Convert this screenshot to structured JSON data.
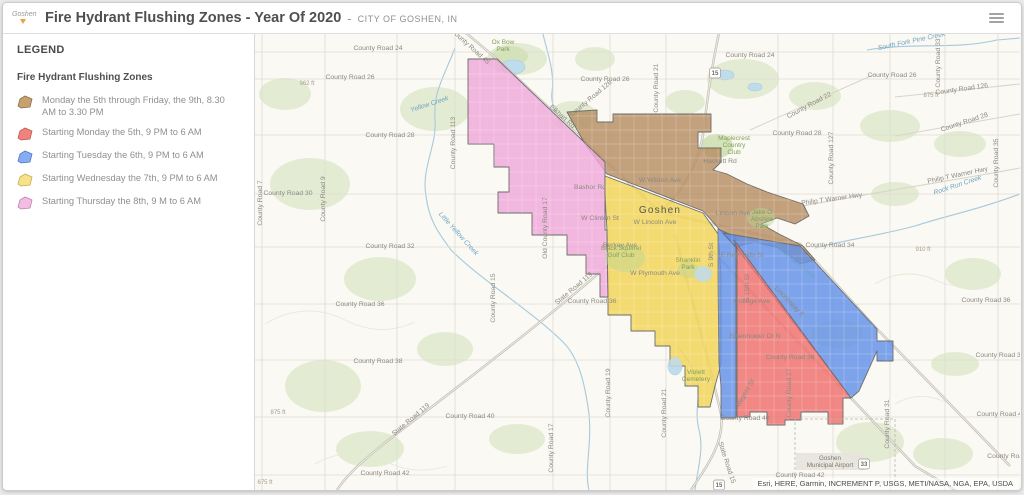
{
  "header": {
    "logo": "Goshen",
    "title": "Fire Hydrant Flushing Zones - Year Of 2020",
    "dash": "-",
    "org": "CITY OF GOSHEN, IN"
  },
  "legend": {
    "panel_title": "LEGEND",
    "layer_title": "Fire Hydrant Flushing Zones",
    "items": [
      {
        "label": "Monday the 5th through Friday, the 9th, 8.30 AM to 3.30 PM",
        "fill": "#C7A06F",
        "stroke": "#8F6F45"
      },
      {
        "label": "Starting Monday the 5th, 9 PM to 6 AM",
        "fill": "#F0837B",
        "stroke": "#C2574F"
      },
      {
        "label": "Starting Tuesday the 6th, 9 PM to 6 AM",
        "fill": "#86ACF1",
        "stroke": "#5377BF"
      },
      {
        "label": "Starting Wednesday the 7th, 9 PM to 6 AM",
        "fill": "#F6E388",
        "stroke": "#C3AC4E"
      },
      {
        "label": "Starting Thursday the 8th, 9 M to 6 AM",
        "fill": "#F4BCE3",
        "stroke": "#C081AC"
      }
    ]
  },
  "map": {
    "attribution": "Esri, HERE, Garmin, INCREMENT P, USGS, METI/NASA, NGA, EPA, USDA",
    "colors": {
      "bg": "#FAF9F3",
      "green": "#E3ECD3",
      "green_dark": "#D3E2B8",
      "park_overlay": "#BCD49A",
      "water": "#A6C9DE",
      "pond": "#BFDCEC",
      "grid": "#DEDCD3",
      "road": "#C6C3B9",
      "road_casing": "#BFBCB2",
      "road_core": "#EFEDE6",
      "boundary": "#6B6B6B",
      "contour": "#ECE7D6",
      "airport_box": "#E6E3DC",
      "dash_line": "#B8B5AA",
      "shield_border": "#9A968C"
    },
    "zones": [
      {
        "id": "monday-friday-day",
        "color": "#B78E63",
        "points": "312,78 342,76 342,88 358,88 358,80 456,80 456,98 443,98 443,114 466,114 466,128 458,136 472,140 492,150 512,158 530,164 548,170 554,182 540,190 522,184 506,190 524,200 548,212 560,226 545,230 524,214 500,208 480,213 465,196 448,177 352,140 330,110"
      },
      {
        "id": "thursday-night",
        "color": "#F0A8DB",
        "points": "213,25 242,25 350,128 350,196 352,196 353,263 345,263 345,240 331,240 331,221 312,221 312,201 277,201 277,179 243,179 243,158 254,158 254,133 239,133 239,110 213,110"
      },
      {
        "id": "wednesday-night",
        "color": "#F1D455",
        "points": "350,142 448,179 463,200 466,240 466,330 460,352 455,373 443,373 443,352 430,352 430,332 415,332 415,312 400,312 400,297 376,297 376,281 353,281 353,263 352,196 350,160"
      },
      {
        "id": "tuesday-night-strip",
        "color": "#6290E8",
        "points": "463,195 481,203 481,384 466,384 466,352 464,330 463,250"
      },
      {
        "id": "tuesday-night-wedge",
        "color": "#6290E8",
        "points": "468,199 545,212 622,295 622,307 638,307 638,327 622,327 622,317 604,357 596,364 480,212"
      },
      {
        "id": "monday-night",
        "color": "#EF6F6D",
        "points": "479,206 596,364 588,364 588,390 573,390 573,378 546,378 546,386 530,386 530,391 512,391 512,378 495,378 495,383 482,383 482,214"
      }
    ],
    "grid": {
      "v": [
        7,
        70,
        142,
        200,
        298,
        355,
        411,
        523,
        578,
        635,
        690,
        743
      ],
      "h": [
        18,
        45,
        101,
        160,
        213,
        270,
        326,
        383,
        441
      ]
    },
    "major_roads": [
      "M205,-6 L242,25 L405,178",
      "M405,178 L545,210 L622,295 L755,432",
      "M455,214 L596,364 L660,432 L700,456",
      "M465,-6 C455,40 452,70 448,100 C444,130 425,160 408,176",
      "M420,200 C435,260 455,330 466,380 C470,408 452,432 436,456",
      "M352,232 C300,278 220,340 157,388 C120,416 95,436 82,456"
    ],
    "roads": [
      "M495,96 L620,40",
      "M640,63 L765,50",
      "M640,102 L765,80",
      "M548,172 C610,160 690,148 765,134"
    ],
    "contours": [
      "M10,290 q40,-24 80,-4 q36,18 70,2",
      "M620,250 q30,-18 60,-4 q26,12 52,0",
      "M60,430 q36,-20 72,-2 q30,14 60,4",
      "M640,370 q24,-14 50,-2"
    ],
    "green_areas": [
      [
        262,
        25,
        30,
        16
      ],
      [
        180,
        75,
        35,
        22
      ],
      [
        55,
        150,
        40,
        26
      ],
      [
        125,
        245,
        36,
        22
      ],
      [
        68,
        352,
        38,
        26
      ],
      [
        190,
        315,
        28,
        17
      ],
      [
        318,
        82,
        24,
        15
      ],
      [
        488,
        45,
        36,
        20
      ],
      [
        560,
        62,
        26,
        14
      ],
      [
        635,
        92,
        30,
        16
      ],
      [
        705,
        110,
        26,
        13
      ],
      [
        640,
        160,
        24,
        12
      ],
      [
        718,
        240,
        28,
        16
      ],
      [
        615,
        408,
        34,
        20
      ],
      [
        688,
        420,
        30,
        16
      ],
      [
        115,
        415,
        34,
        18
      ],
      [
        262,
        405,
        28,
        15
      ],
      [
        430,
        68,
        20,
        12
      ],
      [
        582,
        300,
        26,
        14
      ],
      [
        700,
        330,
        24,
        12
      ],
      [
        30,
        60,
        26,
        16
      ],
      [
        340,
        25,
        20,
        12
      ]
    ],
    "green_dark_areas": [
      [
        462,
        112,
        16,
        12
      ],
      [
        255,
        22,
        18,
        10
      ]
    ],
    "park_overlays": [
      [
        506,
        184,
        14,
        10
      ],
      [
        433,
        236,
        11,
        8
      ],
      [
        370,
        224,
        20,
        14
      ]
    ],
    "creeks": [
      "M200,14 C188,45 178,58 180,86 C182,112 166,134 171,162 C174,188 186,202 196,216 C226,246 278,278 308,308 C324,324 330,350 334,380 C337,412 329,436 334,456",
      "M288,0 C292,18 300,38 297,58 C295,74 306,88 310,98",
      "M612,16 C660,8 700,16 742,6 L765,4",
      "M765,160 C722,176 690,182 660,192 C622,202 590,206 560,214",
      "M440,456 C443,432 449,416 444,396 C439,376 446,362 442,346 C438,332 430,322 424,314"
    ],
    "ponds": [
      [
        258,
        33,
        12,
        7
      ],
      [
        470,
        41,
        9,
        5
      ],
      [
        500,
        53,
        7,
        4
      ],
      [
        448,
        240,
        9,
        8
      ],
      [
        420,
        332,
        7,
        9
      ]
    ],
    "pond_overlays": [
      [
        448,
        240,
        9,
        8
      ],
      [
        420,
        332,
        7,
        9
      ]
    ],
    "airport": {
      "box": "540,385 640,385 640,448 540,448",
      "bg": [
        541,
        419,
        68,
        17
      ]
    },
    "labels": [
      {
        "t": "County Road 24",
        "x": 123,
        "y": 16,
        "c": "rd"
      },
      {
        "t": "County Road 24",
        "x": 495,
        "y": 23,
        "c": "rd"
      },
      {
        "t": "County Road 26",
        "x": 95,
        "y": 45,
        "c": "rd"
      },
      {
        "t": "County Road 26",
        "x": 350,
        "y": 47,
        "c": "rd"
      },
      {
        "t": "County Road 26",
        "x": 637,
        "y": 43,
        "c": "rd"
      },
      {
        "t": "County Road 126",
        "x": 707,
        "y": 57,
        "r": -8,
        "c": "rd"
      },
      {
        "t": "County Road 126",
        "x": 337,
        "y": 66,
        "r": -40,
        "c": "rd"
      },
      {
        "t": "County Road 28",
        "x": 135,
        "y": 103,
        "c": "rd"
      },
      {
        "t": "County Road 28",
        "x": 542,
        "y": 101,
        "c": "rd"
      },
      {
        "t": "County Road 28",
        "x": 710,
        "y": 90,
        "r": -18,
        "c": "rd"
      },
      {
        "t": "County Road 30",
        "x": 33,
        "y": 161,
        "c": "rd"
      },
      {
        "t": "County Road 32",
        "x": 135,
        "y": 214,
        "c": "rd"
      },
      {
        "t": "County Road 34",
        "x": 575,
        "y": 213,
        "c": "rd"
      },
      {
        "t": "County Road 36",
        "x": 105,
        "y": 272,
        "c": "rd"
      },
      {
        "t": "County Road 36",
        "x": 337,
        "y": 269,
        "c": "rd"
      },
      {
        "t": "County Road 36",
        "x": 731,
        "y": 268,
        "c": "rd"
      },
      {
        "t": "County Road 38",
        "x": 123,
        "y": 329,
        "c": "rd"
      },
      {
        "t": "County Road 38",
        "x": 535,
        "y": 325,
        "c": "rd"
      },
      {
        "t": "County Road 38",
        "x": 745,
        "y": 323,
        "c": "rd"
      },
      {
        "t": "County Road 40",
        "x": 215,
        "y": 384,
        "c": "rd"
      },
      {
        "t": "County Road 40",
        "x": 490,
        "y": 386,
        "c": "rd"
      },
      {
        "t": "County Road 40",
        "x": 746,
        "y": 382,
        "c": "rd"
      },
      {
        "t": "County Road 42",
        "x": 130,
        "y": 441,
        "c": "rd"
      },
      {
        "t": "County Road 42",
        "x": 545,
        "y": 443,
        "c": "rd"
      },
      {
        "t": "County Road",
        "x": 752,
        "y": 424,
        "c": "rd"
      },
      {
        "t": "County Road 7",
        "x": 7,
        "y": 169,
        "r": -90,
        "c": "rd"
      },
      {
        "t": "County Road 9",
        "x": 70,
        "y": 165,
        "r": -90,
        "c": "rd"
      },
      {
        "t": "County Road 113",
        "x": 200,
        "y": 109,
        "r": -90,
        "c": "rd"
      },
      {
        "t": "County Road 15",
        "x": 240,
        "y": 264,
        "r": -90,
        "c": "rd"
      },
      {
        "t": "Old County Road 17",
        "x": 292,
        "y": 194,
        "r": -90,
        "c": "rd"
      },
      {
        "t": "County Road 17",
        "x": 298,
        "y": 414,
        "r": -90,
        "c": "rd"
      },
      {
        "t": "County Road 19",
        "x": 355,
        "y": 359,
        "r": -90,
        "c": "rd"
      },
      {
        "t": "County Road 21",
        "x": 403,
        "y": 54,
        "r": -90,
        "c": "rd"
      },
      {
        "t": "County Road 21",
        "x": 411,
        "y": 379,
        "r": -90,
        "c": "rd"
      },
      {
        "t": "County Road 31",
        "x": 634,
        "y": 390,
        "r": -90,
        "c": "rd"
      },
      {
        "t": "County Road 33",
        "x": 685,
        "y": 29,
        "r": -90,
        "c": "rd"
      },
      {
        "t": "County Road 35",
        "x": 743,
        "y": 129,
        "r": -90,
        "c": "rd"
      },
      {
        "t": "County Road 127",
        "x": 578,
        "y": 124,
        "r": -90,
        "c": "rd"
      },
      {
        "t": "County Road 22",
        "x": 555,
        "y": 73,
        "r": -28,
        "c": "rd"
      },
      {
        "t": "County Road 45",
        "x": 214,
        "y": 14,
        "r": 42,
        "c": "rd"
      },
      {
        "t": "Elkhart Rd",
        "x": 306,
        "y": 84,
        "r": 42,
        "c": "rd"
      },
      {
        "t": "State Road 119",
        "x": 320,
        "y": 256,
        "r": -40,
        "c": "rd"
      },
      {
        "t": "State Road 119",
        "x": 157,
        "y": 387,
        "r": -40,
        "c": "rd"
      },
      {
        "t": "State Road 15",
        "x": 470,
        "y": 429,
        "r": 72,
        "c": "rd"
      },
      {
        "t": "Philip T Warner Hwy",
        "x": 577,
        "y": 167,
        "r": -8,
        "c": "rd"
      },
      {
        "t": "Philip T Warner Hwy",
        "x": 703,
        "y": 143,
        "r": -12,
        "c": "rd"
      },
      {
        "t": "Lincolnway E",
        "x": 533,
        "y": 269,
        "r": 46,
        "c": "rd"
      },
      {
        "t": "Bashor Rd",
        "x": 335,
        "y": 155,
        "c": "rd"
      },
      {
        "t": "W Clinton St",
        "x": 345,
        "y": 186,
        "c": "rd"
      },
      {
        "t": "Hackett Rd",
        "x": 465,
        "y": 129,
        "c": "rd"
      },
      {
        "t": "W Wilden Ave",
        "x": 405,
        "y": 148,
        "c": "rd"
      },
      {
        "t": "W Lincoln Ave",
        "x": 400,
        "y": 190,
        "c": "rd"
      },
      {
        "t": "Lincoln Ave",
        "x": 478,
        "y": 181,
        "c": "rd"
      },
      {
        "t": "Berkey Ave",
        "x": 365,
        "y": 213,
        "c": "rd"
      },
      {
        "t": "W Plymouth Ave",
        "x": 400,
        "y": 241,
        "c": "rd"
      },
      {
        "t": "College Ave",
        "x": 497,
        "y": 269,
        "c": "rd"
      },
      {
        "t": "E Reynolds St",
        "x": 487,
        "y": 223,
        "c": "rd"
      },
      {
        "t": "Eisenhower Dr N",
        "x": 500,
        "y": 304,
        "c": "rd"
      },
      {
        "t": "Regent St",
        "x": 492,
        "y": 360,
        "r": -60,
        "c": "rd"
      },
      {
        "t": "County Road 27",
        "x": 536,
        "y": 359,
        "r": -90,
        "c": "rd"
      },
      {
        "t": "S 15th St",
        "x": 494,
        "y": 254,
        "r": -90,
        "c": "rd"
      },
      {
        "t": "S 9th St",
        "x": 458,
        "y": 221,
        "r": -90,
        "c": "rd"
      },
      {
        "t": "Yellow Creek",
        "x": 175,
        "y": 72,
        "r": -18,
        "c": "wt"
      },
      {
        "t": "Little Yellow Creek",
        "x": 202,
        "y": 201,
        "r": 48,
        "c": "wt"
      },
      {
        "t": "South Fork Pine Creek",
        "x": 657,
        "y": 9,
        "r": -12,
        "c": "wt"
      },
      {
        "t": "Rock Run Creek",
        "x": 703,
        "y": 153,
        "r": -18,
        "c": "wt"
      },
      {
        "t": "Rock Run Creek",
        "x": 539,
        "y": 229,
        "r": 40,
        "c": "wt"
      },
      {
        "lines": [
          "Ox Bow",
          "Park"
        ],
        "x": 248,
        "y": 10,
        "c": "gr"
      },
      {
        "lines": [
          "Maplecrest",
          "Country",
          "Club"
        ],
        "x": 479,
        "y": 106,
        "c": "gr"
      },
      {
        "lines": [
          "Jake O",
          "Abshire",
          "Park"
        ],
        "x": 507,
        "y": 180,
        "c": "gr"
      },
      {
        "lines": [
          "Black Squirrel",
          "Golf Club"
        ],
        "x": 366,
        "y": 216,
        "c": "gr"
      },
      {
        "lines": [
          "Shanklin",
          "Park"
        ],
        "x": 433,
        "y": 228,
        "c": "gr"
      },
      {
        "lines": [
          "Violett",
          "Cemetery"
        ],
        "x": 441,
        "y": 340,
        "c": "gr"
      },
      {
        "t": "962 ft",
        "x": 52,
        "y": 51,
        "c": "el"
      },
      {
        "t": "875 ft",
        "x": 676,
        "y": 63,
        "c": "el"
      },
      {
        "t": "910 ft",
        "x": 668,
        "y": 217,
        "c": "el"
      },
      {
        "t": "875 ft",
        "x": 23,
        "y": 380,
        "c": "el"
      },
      {
        "t": "675 ft",
        "x": 10,
        "y": 450,
        "c": "el"
      },
      {
        "t": "Goshen",
        "x": 405,
        "y": 179,
        "c": "ct"
      },
      {
        "lines": [
          "Goshen",
          "Municipal Airport"
        ],
        "x": 575,
        "y": 426,
        "c": "ap"
      }
    ],
    "shields": [
      {
        "t": "15",
        "x": 460,
        "y": 39
      },
      {
        "t": "15",
        "x": 464,
        "y": 451
      },
      {
        "t": "33",
        "x": 609,
        "y": 430
      }
    ]
  }
}
